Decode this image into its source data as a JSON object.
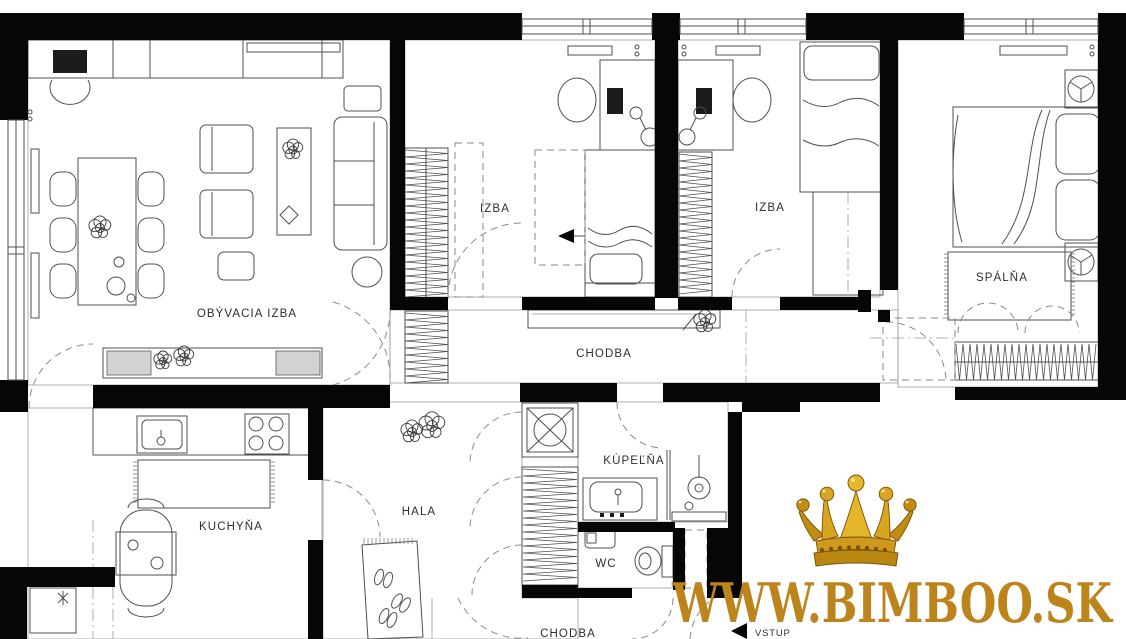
{
  "colors": {
    "wall": "#060606",
    "line": "#555555",
    "gold": "#bd841c"
  },
  "rooms": {
    "living": {
      "label": "OBÝVACIA IZBA"
    },
    "room1": {
      "label": "IZBA"
    },
    "room2": {
      "label": "IZBA"
    },
    "bedroom": {
      "label": "SPÁLŇA"
    },
    "corridor": {
      "label": "CHODBA"
    },
    "kitchen": {
      "label": "KUCHYŇA"
    },
    "hall": {
      "label": "HALA"
    },
    "bathroom": {
      "label": "KÚPEĽŇA"
    },
    "wc": {
      "label": "WC"
    },
    "corridor2": {
      "label": "CHODBA"
    },
    "entrance": {
      "label": "VSTUP"
    }
  },
  "watermark": {
    "text": "WWW.BIMBOO.SK",
    "icon": "golden-crown"
  }
}
